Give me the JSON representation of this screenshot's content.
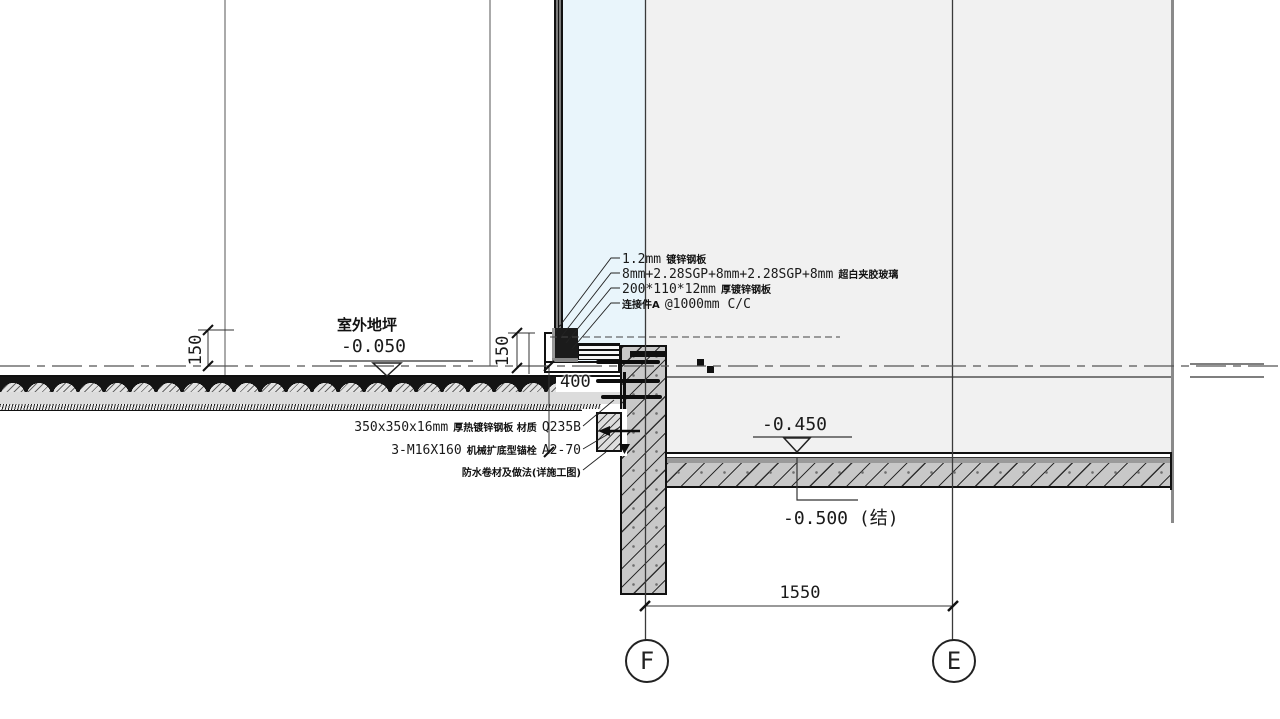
{
  "title": "curtain-wall-base-section-detail",
  "colors": {
    "glass_tint": "#e9f5fb",
    "interior_fill": "#f1f1f1",
    "concrete_fill": "#c8c8c8",
    "line": "#1a1a1a"
  },
  "annotations_top": {
    "a1": {
      "latin": "1.2mm",
      "cn": "镀锌钢板"
    },
    "a2": {
      "latin": "8mm+2.28SGP+8mm+2.28SGP+8mm",
      "cn": "超白夹胶玻璃"
    },
    "a3": {
      "latin": "200*110*12mm",
      "cn": "厚镀锌钢板"
    },
    "a4": {
      "cn": "连接件A",
      "latin": "@1000mm C/C"
    }
  },
  "annotations_bottom": {
    "b1": {
      "p1": "350x350x16mm",
      "p2": "厚热镀锌钢板 材质",
      "p3": "Q235B"
    },
    "b2": {
      "p1": "3-M16X160",
      "p2": "机械扩底型锚栓",
      "p3": "A2-70"
    },
    "b3": {
      "cn": "防水卷材及做法(详施工图)"
    }
  },
  "levels": {
    "outdoor_label": "室外地坪",
    "outdoor_value": "-0.050",
    "slab_value": "-0.450",
    "structural_value": "-0.500 (结)"
  },
  "dimensions": {
    "d150_left": "150",
    "d150_right": "150",
    "d400": "400",
    "d1550": "1550"
  },
  "grid": {
    "f": "F",
    "e": "E"
  }
}
